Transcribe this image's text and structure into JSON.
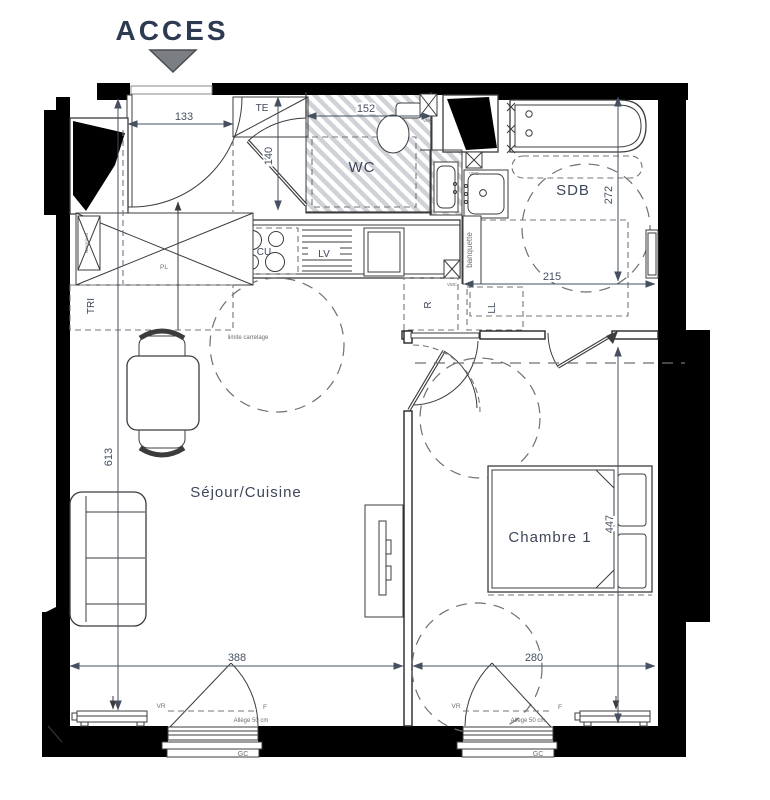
{
  "title": {
    "acces": "ACCES"
  },
  "rooms": {
    "wc": "WC",
    "sdb": "SDB",
    "sejour_cuisine": "Séjour/Cuisine",
    "chambre1": "Chambre 1"
  },
  "equipment": {
    "te": "TE",
    "cu": "CU",
    "lv": "LV",
    "refrigerateur": "R",
    "lave_linge": "LL",
    "tri": "TRI",
    "placard": "PL",
    "banquette": "banquette",
    "nourrices": "Nourrices",
    "vmc": "VMC"
  },
  "annotations": {
    "limite_carrelage": "limite carrelage",
    "allege": "Allège 50 cm",
    "volet_roulant": "VR",
    "fenetre": "F",
    "gc": "GC"
  },
  "dimensions_cm": {
    "entree_largeur": "133",
    "wc_largeur": "152",
    "wc_profondeur": "140",
    "sdb_profondeur": "272",
    "sdb_largeur": "215",
    "sejour_longueur": "613",
    "sejour_largeur": "388",
    "chambre_largeur": "280",
    "chambre_mur": "447"
  },
  "colors": {
    "wall": "#000000",
    "label_ink": "#3d4759",
    "dim_ink": "#465061",
    "line": "#3c3c3c",
    "dash": "#757575",
    "hatch": "#cfd2d6",
    "triangle_fill": "#7b7e83"
  }
}
